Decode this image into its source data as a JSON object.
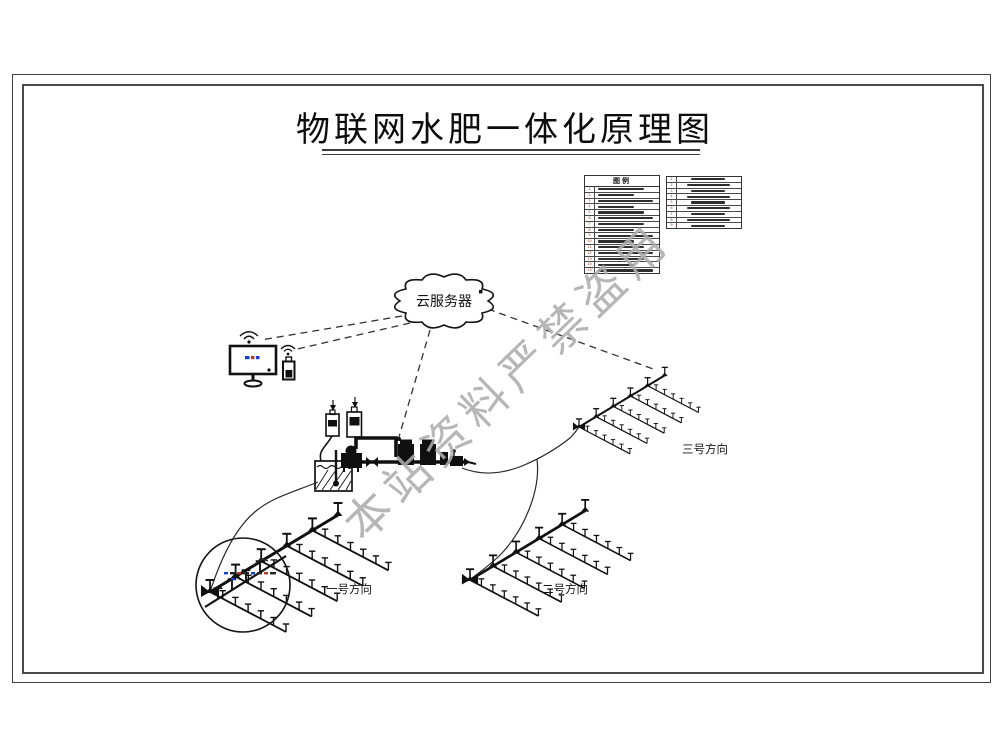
{
  "page": {
    "title": "物联网水肥一体化原理图",
    "watermark": "本站资料严禁盗用"
  },
  "cloud": {
    "label": "云服务器"
  },
  "legend_left": {
    "title": "图例",
    "rows": [
      {
        "num": "1"
      },
      {
        "num": "2"
      },
      {
        "num": "3"
      },
      {
        "num": "4"
      },
      {
        "num": "5"
      },
      {
        "num": "6"
      },
      {
        "num": "7"
      },
      {
        "num": "8"
      },
      {
        "num": "9"
      },
      {
        "num": "10"
      },
      {
        "num": "11"
      },
      {
        "num": "12"
      },
      {
        "num": "13"
      },
      {
        "num": "14"
      },
      {
        "num": "15"
      }
    ]
  },
  "legend_right": {
    "rows": [
      {
        "num": "1"
      },
      {
        "num": "2"
      },
      {
        "num": "3"
      },
      {
        "num": "4"
      },
      {
        "num": "5"
      },
      {
        "num": "6"
      },
      {
        "num": "7"
      },
      {
        "num": "8"
      },
      {
        "num": "9"
      }
    ]
  },
  "fields": {
    "field1_label": "一号方向",
    "field2_label": "二号方向",
    "field3_label": "三号方向"
  }
}
